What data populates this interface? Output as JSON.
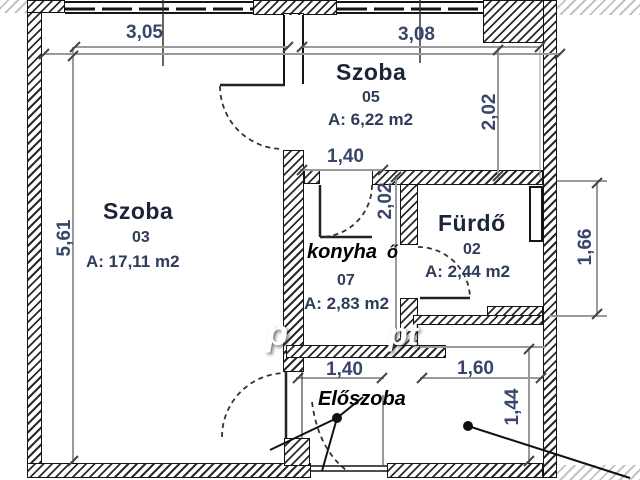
{
  "plan": {
    "rooms": [
      {
        "name": "Szoba",
        "id": "03",
        "area": "A: 17,11 m2"
      },
      {
        "name": "Szoba",
        "id": "05",
        "area": "A: 6,22 m2"
      },
      {
        "name": "Fürdő",
        "id": "02",
        "area": "A: 2,44 m2"
      },
      {
        "name": "",
        "id": "07",
        "area": "A: 2,83 m2"
      }
    ],
    "annotations": {
      "kitchen": "konyha",
      "kitchen_fragment": "ő",
      "hall": "Előszoba"
    },
    "dimensions": {
      "top_width_left": "3,05",
      "top_width_right": "3,08",
      "left_height": "5,61",
      "room05_height": "2,02",
      "kitchen_door_width": "1,40",
      "kitchen_height": "2,02",
      "bath_height": "1,66",
      "hall_width_left": "1,40",
      "hall_width_right": "1,60",
      "hall_height": "1,44"
    },
    "watermark": {
      "fragment_left": "p",
      "fragment_right": "pt"
    },
    "colors": {
      "dim_text": "#39456b",
      "label_text": "#1b2538",
      "wall_line": "#141414",
      "dim_line": "#9a9a9a"
    }
  }
}
